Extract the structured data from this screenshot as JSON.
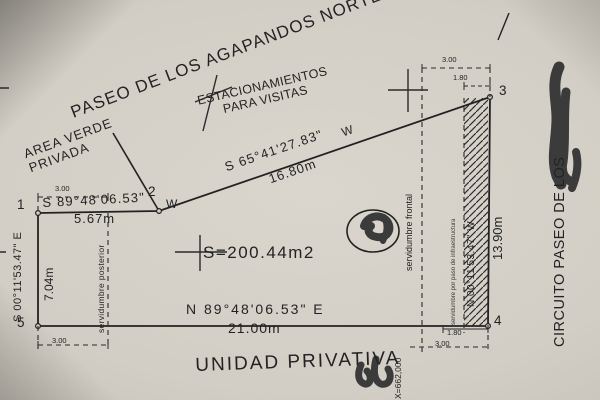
{
  "streets": {
    "top": "PASEO DE LOS AGAPANDOS NORTE",
    "right": "CIRCUITO PASEO DE LOS"
  },
  "zones": {
    "parking_line1": "ESTACIONAMIENTOS",
    "parking_line2": "PARA VISITAS",
    "green_line1": "AREA VERDE",
    "green_line2": "PRIVADA",
    "unit": "UNIDAD PRIVATIVA"
  },
  "area_label": "S=200.44m2",
  "grid_label": "X=662,000",
  "sides": {
    "top": {
      "bearing": "S 89°48'06.53\"",
      "dir": "W",
      "len": "5.67m"
    },
    "diag": {
      "bearing": "S 65°41'27.83\"",
      "dir": "W",
      "len": "16.80m"
    },
    "right": {
      "bearing": "N 00°11'53.47\" W",
      "len": "13.90m"
    },
    "bottom": {
      "bearing": "N 89°48'06.53\" E",
      "len": "21.00m"
    },
    "left": {
      "bearing": "S 00°11'53.47\" E",
      "len": "7.04m"
    }
  },
  "easements": {
    "rear": "servidumbre posterior",
    "front": "servidumbre frontal",
    "infra": "servidumbre por paso de infraestructura"
  },
  "vertices": [
    "1",
    "2",
    "3",
    "4",
    "5"
  ],
  "dims": {
    "tl": "3.00",
    "bl": "3.00",
    "tr_outer": "3.00",
    "tr_inner": "1.80",
    "br_inner": "1.80",
    "br_outer": "3.00"
  }
}
